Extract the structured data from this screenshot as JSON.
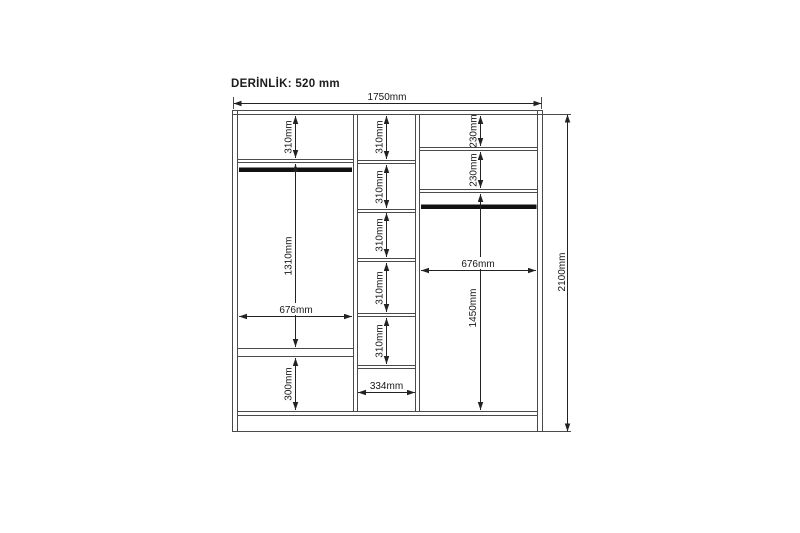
{
  "diagram_title": {
    "depth_label": "DERİNLİK: 520 mm"
  },
  "dimensions": {
    "overall_width": "1750mm",
    "overall_height": "2100mm",
    "left_section": {
      "top_compartment": "310mm",
      "hanging_area": "1310mm",
      "width": "676mm",
      "bottom_compartment": "300mm"
    },
    "middle_section": {
      "compartments": [
        "310mm",
        "310mm",
        "310mm",
        "310mm",
        "310mm"
      ],
      "width": "334mm"
    },
    "right_section": {
      "compartments": [
        "230mm",
        "230mm"
      ],
      "width": "676mm",
      "lower_area": "1450mm"
    }
  }
}
